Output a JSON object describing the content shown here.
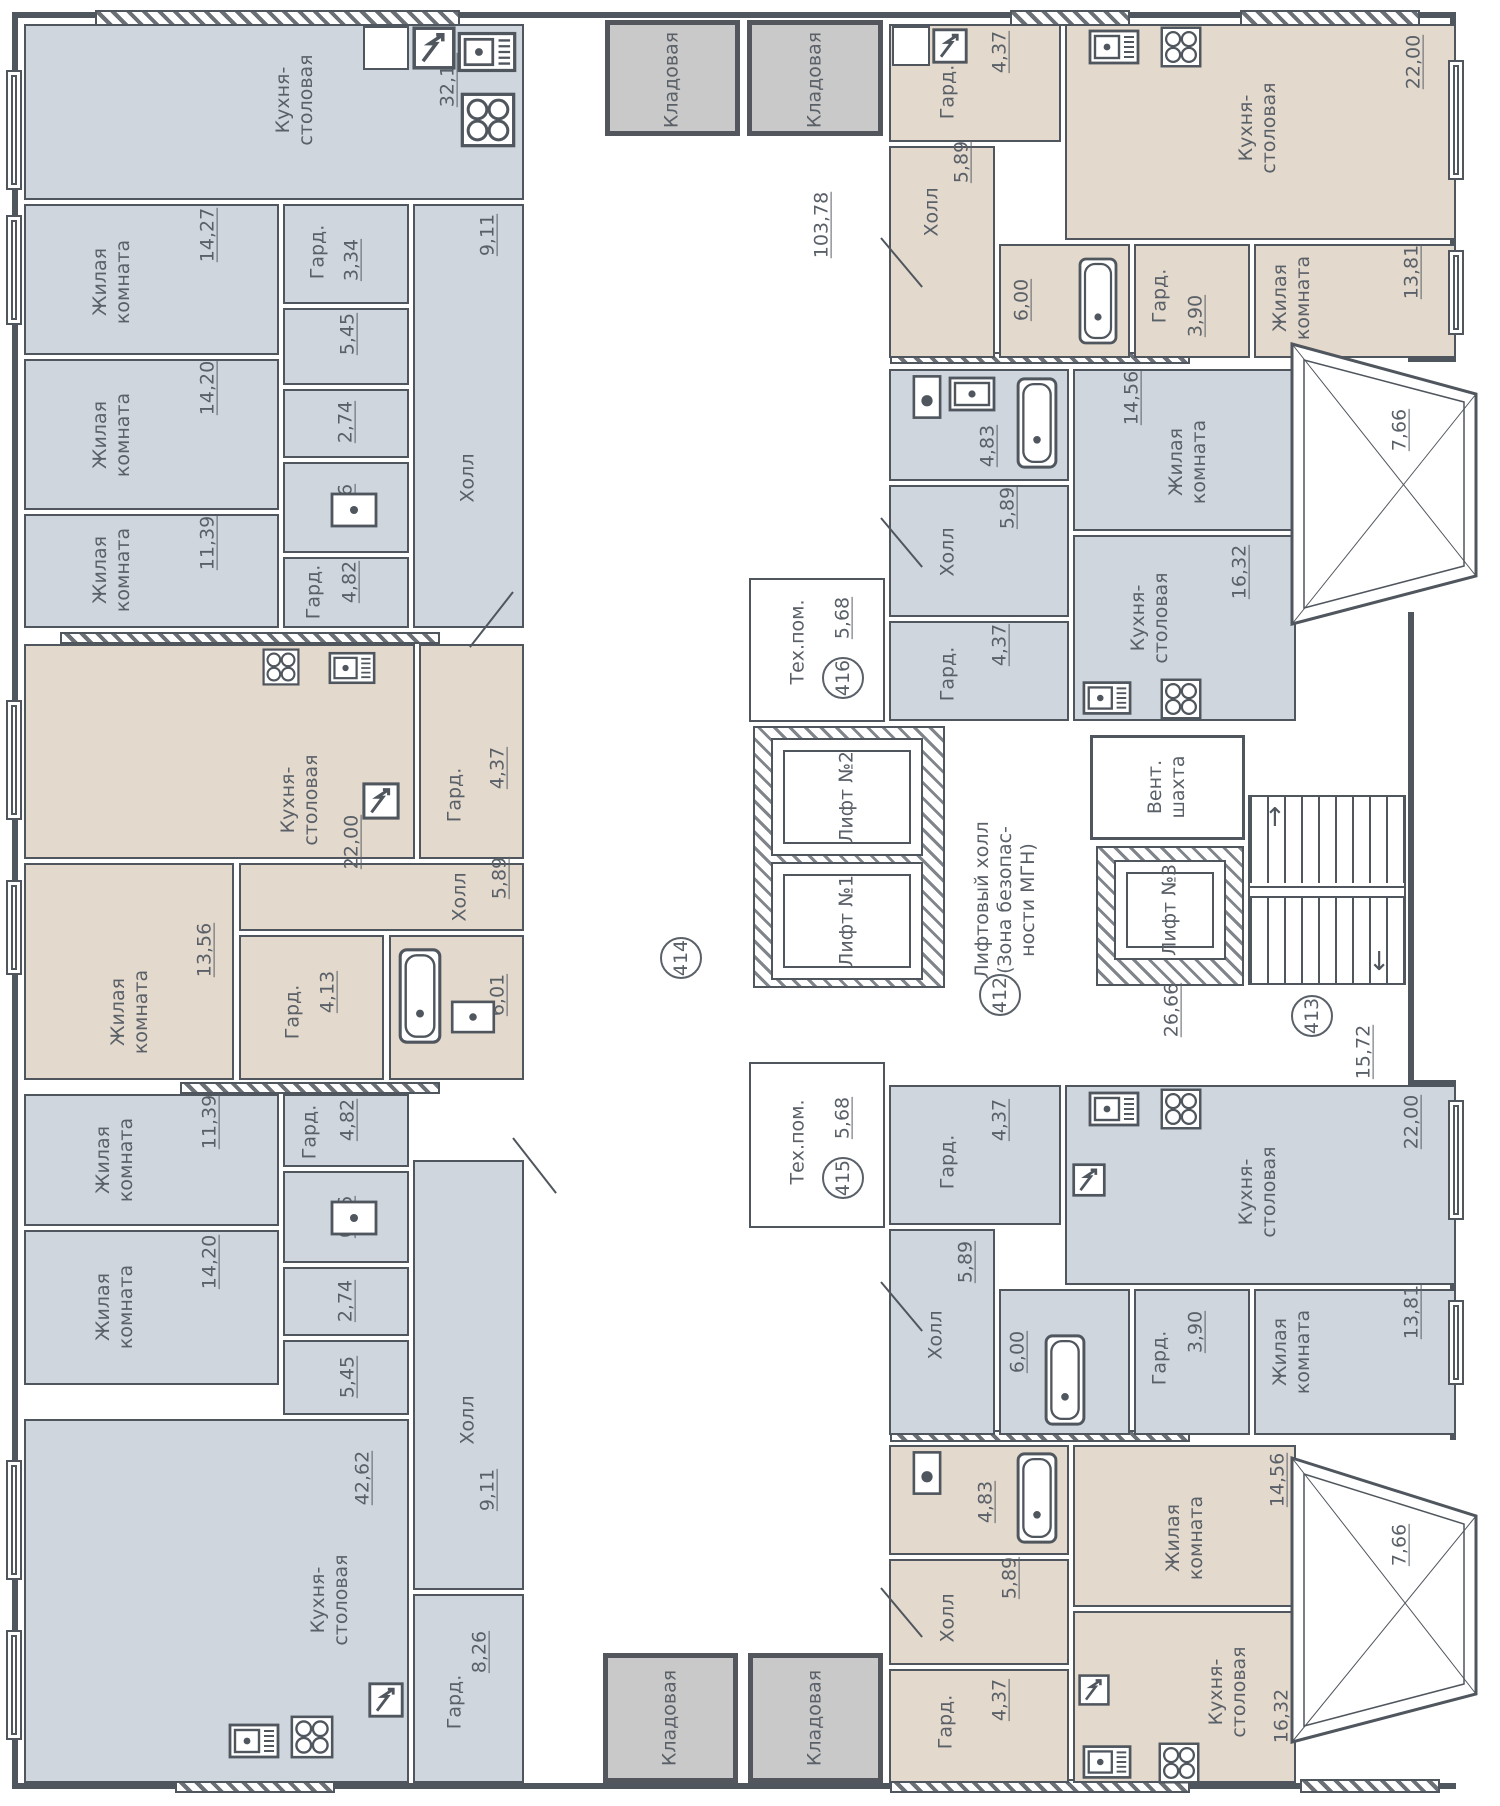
{
  "colors": {
    "room_blue": "#cfd6de",
    "room_beige": "#e3d9cc",
    "storage_gray": "#c9c9c9",
    "wall": "#50565e",
    "text": "#5a6068"
  },
  "storage": {
    "label": "Кладовая"
  },
  "rooms": {
    "tl_kitchen": {
      "name": "Кухня-\nстоловая",
      "area": "32,14"
    },
    "tl_living1": {
      "name": "Жилая\nкомната",
      "area": "14,27"
    },
    "tl_gard1": {
      "name": "Гард.",
      "area": "3,34"
    },
    "tl_hall": {
      "name": "Холл",
      "area": "9,11"
    },
    "tl_corr": {
      "area": "5,45"
    },
    "tl_bath1": {
      "area": "2,74"
    },
    "tl_bath2": {
      "area": "6,46"
    },
    "tl_gard2": {
      "name": "Гард.",
      "area": "4,82"
    },
    "tl_living2": {
      "name": "Жилая\nкомната",
      "area": "14,20"
    },
    "tl_living3": {
      "name": "Жилая\nкомната",
      "area": "11,39"
    },
    "ml_kitchen": {
      "name": "Кухня-\nстоловая",
      "area": "22,00"
    },
    "ml_gard1": {
      "name": "Гард.",
      "area": "4,37"
    },
    "ml_hall": {
      "name": "Холл",
      "area": "5,89"
    },
    "ml_living": {
      "name": "Жилая\nкомната",
      "area": "13,56"
    },
    "ml_gard2": {
      "name": "Гард.",
      "area": "4,13"
    },
    "ml_bath": {
      "area": "6,01"
    },
    "bl_living1": {
      "name": "Жилая\nкомната",
      "area": "11,39"
    },
    "bl_gard1": {
      "name": "Гард.",
      "area": "4,82"
    },
    "bl_bath2": {
      "area": "6,46"
    },
    "bl_bath1": {
      "area": "2,74"
    },
    "bl_corr": {
      "area": "5,45"
    },
    "bl_living2": {
      "name": "Жилая\nкомната",
      "area": "14,20"
    },
    "bl_hall": {
      "name": "Холл",
      "area": "9,11"
    },
    "bl_kitchen": {
      "name": "Кухня-\nстоловая",
      "area": "42,62"
    },
    "bl_gard2": {
      "name": "Гард.",
      "area": "8,26"
    },
    "tr_gard1": {
      "name": "Гард.",
      "area": "4,37"
    },
    "tr_hall": {
      "name": "Холл",
      "area": "5,89"
    },
    "tr_kitchen": {
      "name": "Кухня-\nстоловая",
      "area": "22,00"
    },
    "tr_bath": {
      "area": "6,00"
    },
    "tr_gard2": {
      "name": "Гард.",
      "area": "3,90"
    },
    "tr_living": {
      "name": "Жилая\nкомната",
      "area": "13,81"
    },
    "mr_bath": {
      "area": "4,83"
    },
    "mr_hall": {
      "name": "Холл",
      "area": "5,89"
    },
    "mr_gard": {
      "name": "Гард.",
      "area": "4,37"
    },
    "mr_living": {
      "name": "Жилая\nкомната",
      "area": "14,56"
    },
    "mr_kitchen": {
      "name": "Кухня-\nстоловая",
      "area": "16,32"
    },
    "mr_balcony": {
      "area": "7,66"
    },
    "br_gard1": {
      "name": "Гард.",
      "area": "4,37"
    },
    "br_hall": {
      "name": "Холл",
      "area": "5,89"
    },
    "br_kitchen": {
      "name": "Кухня-\nстоловая",
      "area": "22,00"
    },
    "br_bath": {
      "area": "6,00"
    },
    "br_gard2": {
      "name": "Гард.",
      "area": "3,90"
    },
    "br_living": {
      "name": "Жилая\nкомната",
      "area": "13,81"
    },
    "bb_bath": {
      "area": "4,83"
    },
    "bb_hall": {
      "name": "Холл",
      "area": "5,89"
    },
    "bb_gard": {
      "name": "Гард.",
      "area": "4,37"
    },
    "bb_living": {
      "name": "Жилая\nкомната",
      "area": "14,56"
    },
    "bb_kitchen": {
      "name": "Кухня-\nстоловая",
      "area": "16,32"
    },
    "bb_balcony": {
      "area": "7,66"
    }
  },
  "core": {
    "corridor_area": "103,78",
    "tech416": {
      "name": "Тех.пом.",
      "area": "5,68",
      "num": "416"
    },
    "tech415": {
      "name": "Тех.пом.",
      "area": "5,68",
      "num": "415"
    },
    "lift1": "Лифт №1",
    "lift2": "Лифт №2",
    "lift3": "Лифт №3",
    "lift_hall": "Лифтовый холл\n(Зона безопас-\nности МГН)",
    "vent": "Вент.\nшахта",
    "stair_hall_area": "26,66",
    "hall413_area": "15,72",
    "unit412": "412",
    "unit413": "413",
    "unit414": "414"
  }
}
